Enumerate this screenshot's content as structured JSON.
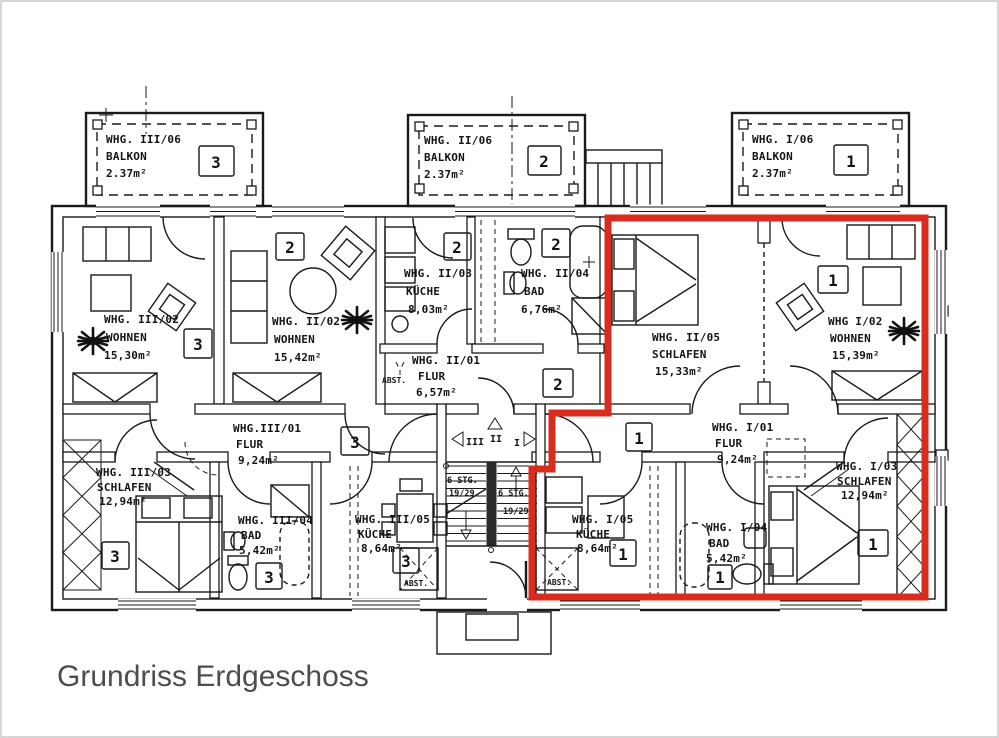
{
  "caption": "Grundriss Erdgeschoss",
  "balconies": [
    {
      "unit": "WHG. III/06",
      "room": "BALKON",
      "area": "2.37m²",
      "number": "3"
    },
    {
      "unit": "WHG. II/06",
      "room": "BALKON",
      "area": "2.37m²",
      "number": "2"
    },
    {
      "unit": "WHG. I/06",
      "room": "BALKON",
      "area": "2.37m²",
      "number": "1"
    }
  ],
  "rooms": {
    "wohnen3": {
      "unit": "WHG. III/02",
      "room": "WOHNEN",
      "area": "15,30m²",
      "number": "3"
    },
    "wohnen2": {
      "unit": "WHG. II/02",
      "room": "WOHNEN",
      "area": "15,42m²",
      "number": "2"
    },
    "kueche2": {
      "unit": "WHG. II/03",
      "room": "KÜCHE",
      "area": "8,03m²",
      "number": "2"
    },
    "bad2": {
      "unit": "WHG. II/04",
      "room": "BAD",
      "area": "6,76m²",
      "number": "2"
    },
    "flur2": {
      "unit": "WHG. II/01",
      "room": "FLUR",
      "area": "6,57m²",
      "number": "2"
    },
    "schlafen2": {
      "unit": "WHG. II/05",
      "room": "SCHLAFEN",
      "area": "15,33m²"
    },
    "wohnen1": {
      "unit": "WHG I/02",
      "room": "WOHNEN",
      "area": "15,39m²",
      "number": "1"
    },
    "flur3": {
      "unit": "WHG.III/01",
      "room": "FLUR",
      "area": "9,24m²",
      "number": "3"
    },
    "flur1": {
      "unit": "WHG. I/01",
      "room": "FLUR",
      "area": "9,24m²",
      "number": "1"
    },
    "schlafen3": {
      "unit": "WHG. III/03",
      "room": "SCHLAFEN",
      "area": "12,94m²",
      "number": "3"
    },
    "bad3": {
      "unit": "WHG. III/04",
      "room": "BAD",
      "area": "5,42m²",
      "number": "3"
    },
    "kueche3": {
      "unit": "WHG. III/05",
      "room": "KÜCHE",
      "area": "8,64m²",
      "number": "3"
    },
    "kueche1": {
      "unit": "WHG. I/05",
      "room": "KÜCHE",
      "area": "8,64m²",
      "number": "1"
    },
    "bad1": {
      "unit": "WHG. I/04",
      "room": "BAD",
      "area": "5,42m²",
      "number": "1"
    },
    "schlafen1": {
      "unit": "WHG. I/03",
      "room": "SCHLAFEN",
      "area": "12,94m²",
      "number": "1"
    }
  },
  "stairwell": {
    "flight_left_1": "6 STG.",
    "flight_left_2": "19/29",
    "flight_right_1": "6 STG.",
    "flight_right_2": "19/29",
    "dir_up": "II",
    "dir_left": "III",
    "dir_right": "I"
  },
  "storage_label": "ABST.",
  "colors": {
    "highlight_outline": "#da2c1e",
    "plan_line": "#1a1a1a",
    "caption_text": "#4d4d4d"
  }
}
